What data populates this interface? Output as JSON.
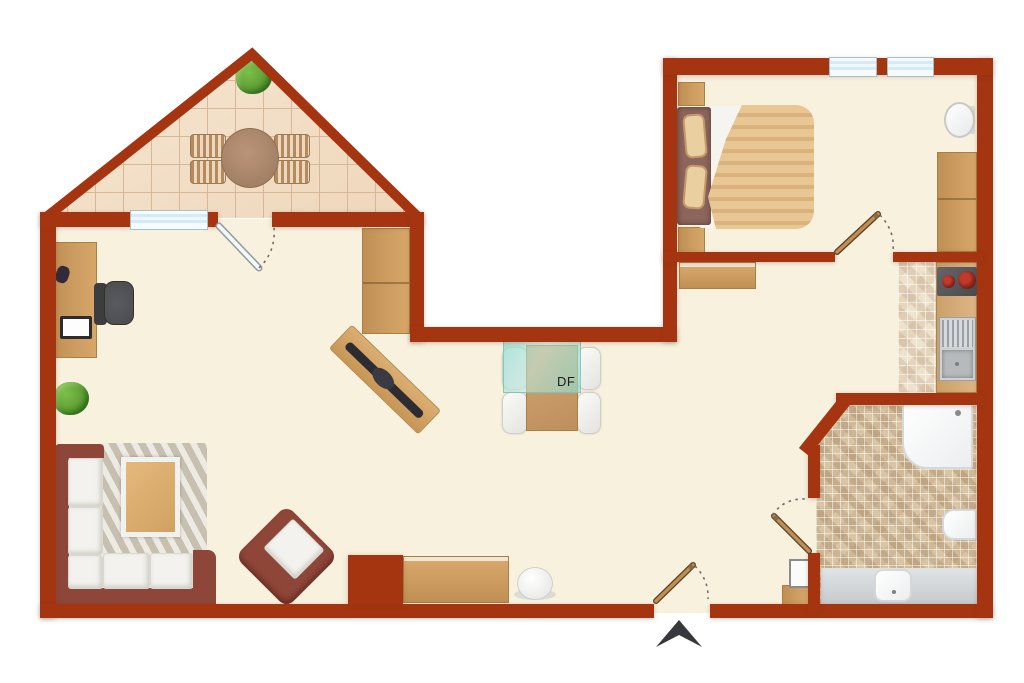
{
  "floorplan": {
    "skylight_label": "DF",
    "entrance_marker": "arrow-up-icon",
    "colors": {
      "wall": "#a53410",
      "floor": "#f8f1de",
      "tile_base": "#f4e0ca",
      "tile_line": "#d6b796",
      "wood": "#d7a76a",
      "wood_dark": "#c08f55",
      "sofa_frame": "#8e4639",
      "cushion": "#f3f2ee",
      "rug": "#dad4c5",
      "rug_stripe": "#c9c2b1",
      "skylight_glass": "#8fd9cc",
      "bath_counter": "#c6cacd",
      "mosaic_base": "#dcc9aa",
      "kitchen_tile_base": "#efe5d2",
      "plant": "#5f9e35",
      "office_chair": "#4a4b4f",
      "arrow": "#36383b",
      "duvet": "#e9c795",
      "duvet_stripe": "#d9b27e",
      "headboard": "#8c655c",
      "pillow": "#eacfa0",
      "window_glass": "#d4ebf5",
      "fixture_white": "#fbfbfa"
    }
  }
}
